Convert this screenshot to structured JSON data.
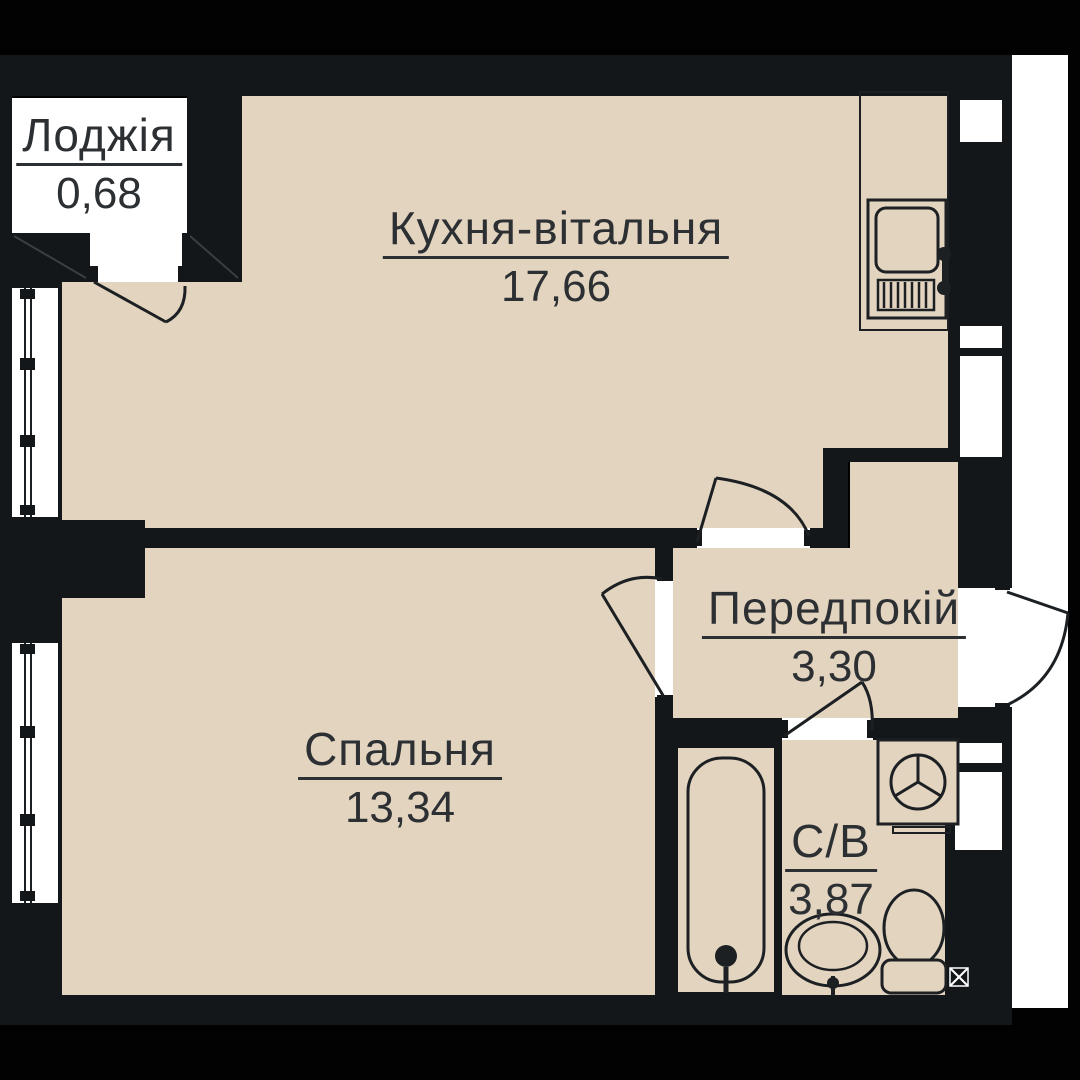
{
  "floorplan": {
    "rooms": [
      {
        "id": "loggia",
        "name": "Лоджія",
        "area": "0,68"
      },
      {
        "id": "kitchen",
        "name": "Кухня-вітальня",
        "area": "17,66"
      },
      {
        "id": "bedroom",
        "name": "Спальня",
        "area": "13,34"
      },
      {
        "id": "hall",
        "name": "Передпокій",
        "area": "3,30"
      },
      {
        "id": "bathroom",
        "name": "С/В",
        "area": "3,87"
      }
    ],
    "fixtures": [
      "kitchen-sink-unit",
      "washing-machine",
      "bathtub",
      "wash-basin",
      "toilet",
      "floor-drain"
    ],
    "colors": {
      "background": "#020202",
      "wall": "#14171a",
      "floor": "#e3d4c0",
      "void": "#ffffff",
      "line": "#1c2023",
      "text": "#2d3033"
    }
  }
}
